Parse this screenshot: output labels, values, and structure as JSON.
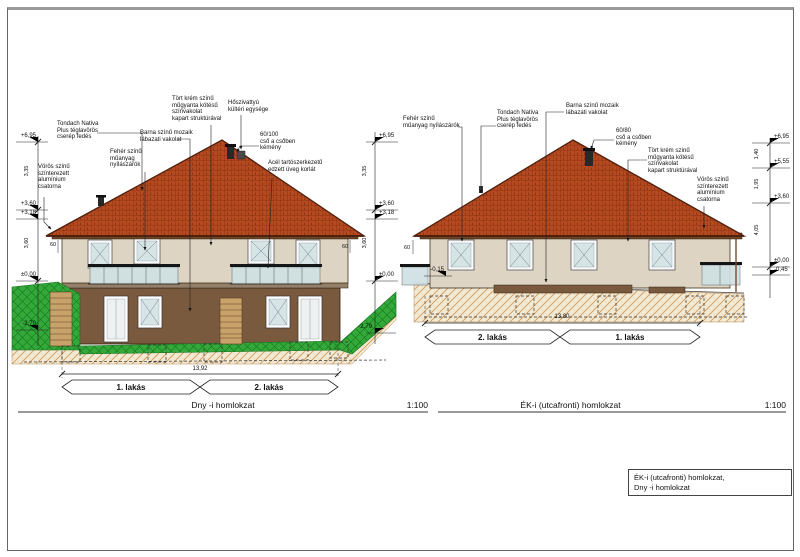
{
  "sheet": {
    "legend": "ÉK-i (utcafronti) homlokzat,\nDny -i homlokzat"
  },
  "left_elevation": {
    "title": "Dny -i homlokzat",
    "scale": "1:100",
    "overall_width": "13,92",
    "unit_labels": {
      "left": "1. lakás",
      "right": "2. lakás"
    },
    "annotations": {
      "roof_tiles": "Tondach Nativa\nPlus téglavörös\ncserép fedés",
      "gutter": "Vörös színű\nszínterezett\nalumínium\ncsatorna",
      "windows": "Fehér színű\nműanyag\nnyílászárók",
      "base_plaster": "Barna színű mozaik\nlábazati vakolat",
      "wall_plaster": "Tört krém színű\nműgyanta kötésű\nszínvakolat\nkapart struktúrával",
      "heat_pump": "Hőszivattyú\nkültéri egysége",
      "chimney": "60/100\ncső a csőben\nkémény",
      "glass_railing": "Acél tartószerkezetű\nedzett üveg korlát"
    },
    "levels": {
      "ridge": "+6,95",
      "eave": "+3,60",
      "wall_top": "+3,18",
      "ground": "±0,00",
      "lower_left": "-2,70",
      "lower_right": "-2,79"
    },
    "dims": {
      "upper": "3,35",
      "lower": "3,60",
      "eave_overhang": "60"
    }
  },
  "right_elevation": {
    "title": "ÉK-i (utcafronti) homlokzat",
    "scale": "1:100",
    "overall_width": "13,80",
    "unit_labels": {
      "left": "2. lakás",
      "right": "1. lakás"
    },
    "annotations": {
      "windows": "Fehér színű\nműanyag nyílászárók",
      "roof_tiles": "Tondach Nativa\nPlus téglavörös\ncserép fedés",
      "base_plaster": "Barna színű mozaik\nlábazati vakolat",
      "chimney": "60/80\ncső a csőben\nkémény",
      "wall_plaster": "Tört krém színű\nműgyanta kötésű\nszínvakolat\nkapart struktúrával",
      "gutter": "Vörös színű\nszínterezett\nalumínium\ncsatorna"
    },
    "levels": {
      "ridge": "+6,95",
      "mid": "+5,55",
      "eave": "+3,60",
      "ground": "±0,00",
      "below": "-0,45",
      "terrain": "-0,15"
    },
    "dims": {
      "d1": "1,40",
      "d2": "1,95",
      "d3": "4,05",
      "eave_overhang": "60"
    }
  },
  "colors": {
    "roof_tile": "#b5491f",
    "roof_edge": "#4d1f0c",
    "upper_wall": "#ddd4c3",
    "base_wall": "#7a5a3e",
    "terrain_green": "#33a93a",
    "soil_hatch": "#d2a268",
    "glass": "#d7e4e6",
    "railing": "#151515"
  }
}
